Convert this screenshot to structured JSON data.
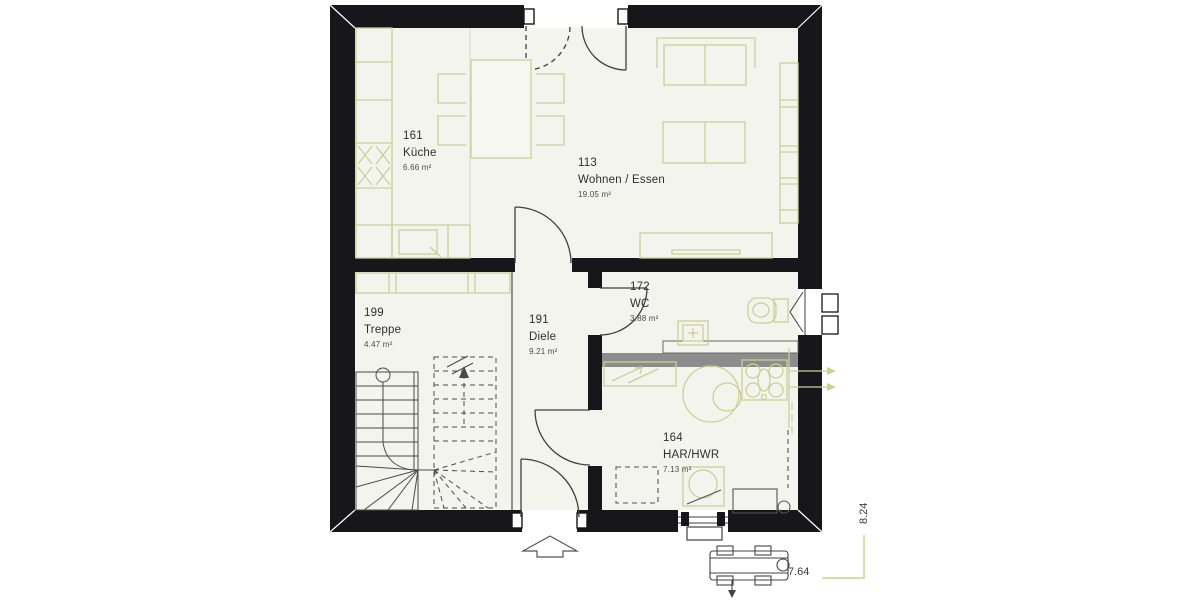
{
  "plan": {
    "title": "floor-plan",
    "rooms": [
      {
        "id": "161",
        "name": "Küche",
        "area": "6.66 m²"
      },
      {
        "id": "113",
        "name": "Wohnen / Essen",
        "area": "19.05 m²"
      },
      {
        "id": "199",
        "name": "Treppe",
        "area": "4.47 m²"
      },
      {
        "id": "191",
        "name": "Diele",
        "area": "9.21 m²"
      },
      {
        "id": "172",
        "name": "WC",
        "area": "3.88 m²"
      },
      {
        "id": "164",
        "name": "HAR/HWR",
        "area": "7.13 m²"
      }
    ],
    "dimensions": {
      "width": "7.64",
      "depth": "8.24"
    },
    "colors": {
      "wall": "#17171b",
      "floor": "#f4f4ef",
      "furniture": "#c9d193",
      "partition_gray": "#8d8d8d",
      "drawing_lines": "#3f3f3f",
      "dimension_green": "#cbd389",
      "text": "#2e2e2e"
    }
  }
}
